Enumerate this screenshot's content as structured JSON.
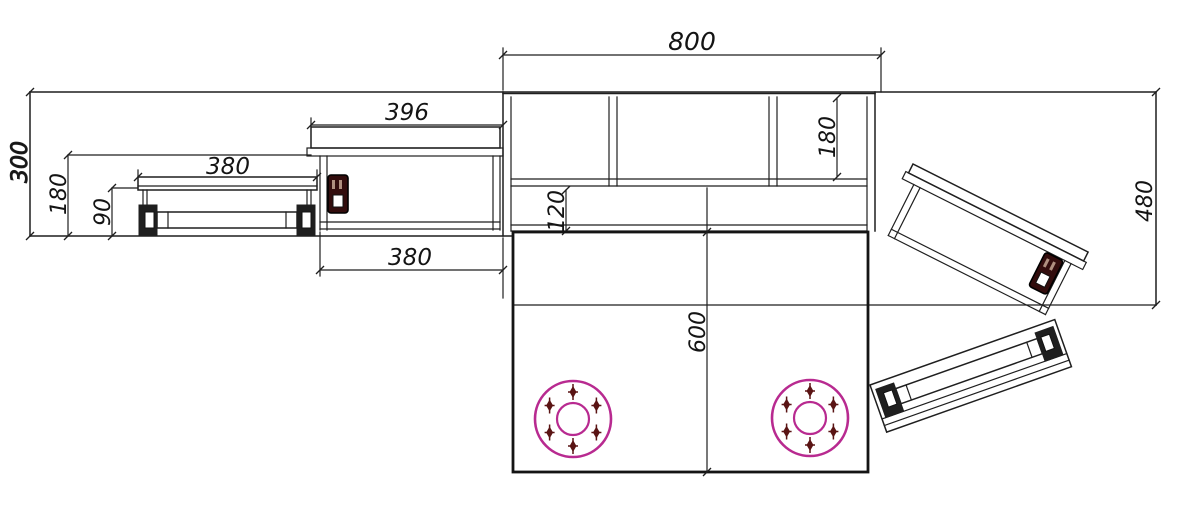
{
  "dimensions": {
    "main_unit_width": "800",
    "feed_table_width": "396",
    "feed_bench_length": "380",
    "feed_table_base_width": "380",
    "overall_height": "300",
    "feed_table_height": "180",
    "feed_bench_height": "90",
    "apron_height": "120",
    "panel_height": "180",
    "right_side_height": "480",
    "main_table_length": "600"
  },
  "colors": {
    "line": "#1f1f1f",
    "flange_circle": "#b82a90",
    "cross_marker": "#5a1414",
    "motor_body": "#330d0d",
    "motor_stripe": "#b09080",
    "background": "#ffffff",
    "text": "#141414"
  }
}
